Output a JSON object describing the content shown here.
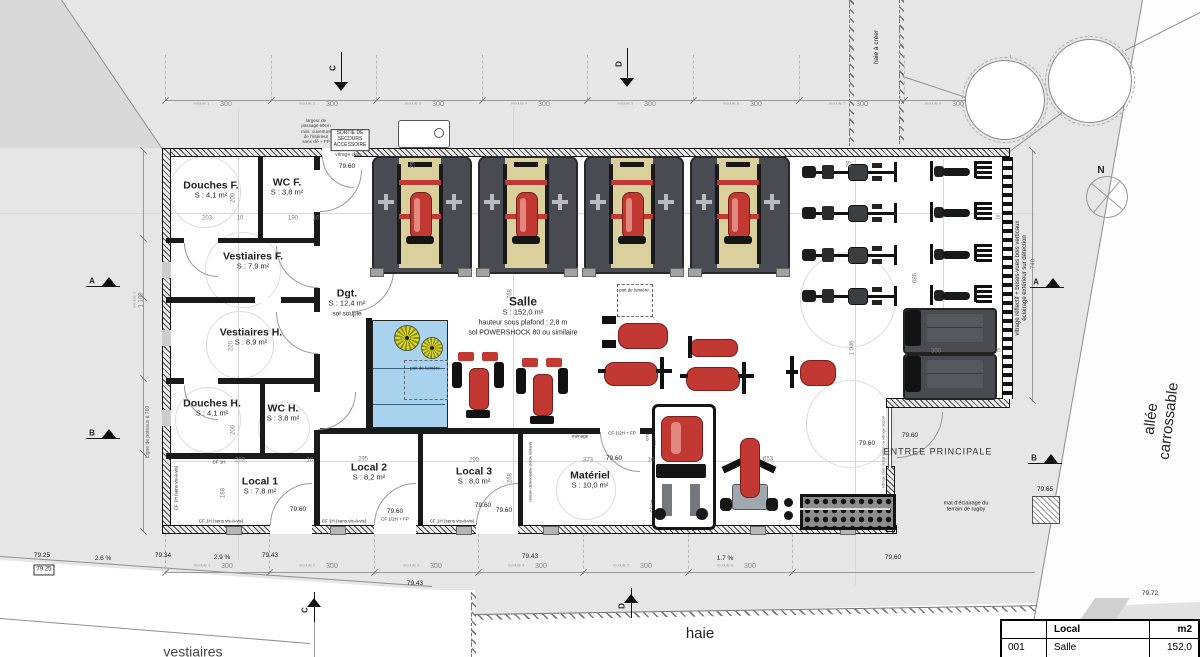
{
  "legend": {
    "col_local": "Local",
    "col_m2": "m2",
    "row_num": "001",
    "row_name": "Salle",
    "row_area": "152,0"
  },
  "rooms": [
    {
      "name": "Douches F.",
      "area": "S : 4,1 m²",
      "x": 211,
      "y": 190
    },
    {
      "name": "WC F.",
      "area": "S : 3,8 m²",
      "x": 287,
      "y": 187
    },
    {
      "name": "Vestiaires F.",
      "area": "S : 7,9 m²",
      "x": 253,
      "y": 261
    },
    {
      "name": "Dgt.",
      "area": "S : 12,4 m²",
      "notes": [
        "sol souple"
      ],
      "x": 347,
      "y": 303
    },
    {
      "name": "Vestiaires H.",
      "area": "S : 8,9 m²",
      "x": 251,
      "y": 337
    },
    {
      "name": "Douches H.",
      "area": "S : 4,1 m²",
      "x": 212,
      "y": 408
    },
    {
      "name": "WC H.",
      "area": "S : 3,8 m²",
      "x": 283,
      "y": 413
    },
    {
      "name": "Local 1",
      "area": "S : 7,8 m²",
      "x": 260,
      "y": 486
    },
    {
      "name": "Local 2",
      "area": "S : 8,2 m²",
      "x": 369,
      "y": 472
    },
    {
      "name": "Local 3",
      "area": "S : 8,0 m²",
      "x": 474,
      "y": 476
    },
    {
      "name": "Matériel",
      "area": "S : 10,0 m²",
      "x": 590,
      "y": 480
    },
    {
      "name": "Salle",
      "area": "S : 152,0 m²",
      "notes": [
        "hauteur sous plafond : 2,8 m",
        "sol POWERSHOCK 80 ou similaire"
      ],
      "x": 523,
      "y": 316,
      "big": 1
    }
  ],
  "labels": [
    {
      "t": "largeur de\npassage 90cm\nmini. ouverture\nde l'intérieur\nsans clé + FP",
      "x": 316,
      "y": 131,
      "s": 4.5,
      "c": "#444"
    },
    {
      "t": "SORTIE DE\nSECOURS\nACCESSOIRE",
      "x": 350,
      "y": 140,
      "s": 5,
      "bx": 1
    },
    {
      "t": "vitrage clair",
      "x": 348,
      "y": 156,
      "s": 5,
      "c": "#555"
    },
    {
      "t": "79.60",
      "x": 347,
      "y": 167
    },
    {
      "t": "puit de lumière",
      "x": 425,
      "y": 368,
      "s": 4.5
    },
    {
      "t": "puit de lumière",
      "x": 634,
      "y": 290,
      "s": 4.5
    },
    {
      "t": "ménage",
      "x": 580,
      "y": 436,
      "s": 4.5
    },
    {
      "t": "CF 1H",
      "x": 219,
      "y": 462,
      "s": 4.5
    },
    {
      "t": "CF 1H",
      "x": 363,
      "y": 432,
      "s": 4.5
    },
    {
      "t": "CF 1H",
      "x": 468,
      "y": 432,
      "s": 4.5
    },
    {
      "t": "CF 1H",
      "x": 559,
      "y": 432,
      "s": 4.5
    },
    {
      "t": "CF 1/2H + FP",
      "x": 622,
      "y": 433,
      "s": 4.5
    },
    {
      "t": "CF 1/2H + FP",
      "x": 395,
      "y": 519,
      "s": 4.5
    },
    {
      "t": "CF 1H (sens vis-à-vis)",
      "x": 221,
      "y": 521,
      "s": 4.5
    },
    {
      "t": "CF 1H (sens vis-à-vis)",
      "x": 344,
      "y": 521,
      "s": 4.5
    },
    {
      "t": "CF 1H (sens vis-à-vis)",
      "x": 452,
      "y": 521,
      "s": 4.5
    },
    {
      "t": "CF 1H (sens vis-à-vis)",
      "x": 176,
      "y": 488,
      "s": 4.5,
      "r": -90
    },
    {
      "t": "CF 1H",
      "x": 652,
      "y": 506,
      "s": 4.5,
      "r": -90
    },
    {
      "t": "cloison démontable (socle isolant)",
      "x": 531,
      "y": 472,
      "s": 4,
      "r": -90
    },
    {
      "t": "GTL",
      "x": 648,
      "y": 437,
      "s": 4,
      "r": -90
    },
    {
      "t": "TGBT",
      "x": 655,
      "y": 443,
      "s": 4,
      "r": -90
    },
    {
      "t": "vitrage clair sérigraphié ou vitrage dépoli",
      "x": 884,
      "y": 452,
      "s": 4,
      "r": -90,
      "c": "#555"
    },
    {
      "t": "vitrage réflectif + brises-vues bois verticaux\néclairage extérieur sur détection",
      "x": 1022,
      "y": 278,
      "s": 6,
      "r": -90
    },
    {
      "t": "ENTREE PRINCIPALE",
      "x": 938,
      "y": 452,
      "s": 9,
      "ls": 1,
      "c": "#333"
    },
    {
      "t": "mat d'éclairage du\nterrain de rugby",
      "x": 966,
      "y": 507,
      "s": 5.5
    },
    {
      "t": "hortensia\nconservé",
      "x": 1005,
      "y": 101,
      "s": 6
    },
    {
      "t": "hortensia\nconservé",
      "x": 1090,
      "y": 80,
      "s": 6
    },
    {
      "t": "haie à créer",
      "x": 877,
      "y": 47,
      "s": 6.5,
      "r": -90
    },
    {
      "t": "haie",
      "x": 700,
      "y": 634,
      "s": 15
    },
    {
      "t": "allée carrossable",
      "x": 1160,
      "y": 420,
      "s": 15,
      "r": -83
    },
    {
      "t": "vestiaires",
      "x": 193,
      "y": 652,
      "s": 14,
      "c": "#444"
    },
    {
      "t": "N",
      "x": 1101,
      "y": 171,
      "s": 10,
      "b": 1
    },
    {
      "t": "203",
      "x": 207,
      "y": 219,
      "dim": 1
    },
    {
      "t": "10",
      "x": 240,
      "y": 219,
      "dim": 1
    },
    {
      "t": "190",
      "x": 293,
      "y": 219,
      "dim": 1
    },
    {
      "t": "10",
      "x": 316,
      "y": 219,
      "dim": 1
    },
    {
      "t": "200",
      "x": 234,
      "y": 198,
      "r": -90,
      "dim": 1
    },
    {
      "t": "220",
      "x": 232,
      "y": 346,
      "r": -90,
      "dim": 1
    },
    {
      "t": "200",
      "x": 234,
      "y": 430,
      "r": -90,
      "dim": 1
    },
    {
      "t": "188",
      "x": 224,
      "y": 493,
      "r": -90,
      "dim": 1
    },
    {
      "t": "203",
      "x": 240,
      "y": 461,
      "dim": 1
    },
    {
      "t": "10",
      "x": 310,
      "y": 461,
      "dim": 1
    },
    {
      "t": "295",
      "x": 363,
      "y": 460,
      "dim": 1
    },
    {
      "t": "290",
      "x": 474,
      "y": 461,
      "dim": 1
    },
    {
      "t": "373",
      "x": 588,
      "y": 461,
      "dim": 1
    },
    {
      "t": "10",
      "x": 651,
      "y": 461,
      "dim": 1
    },
    {
      "t": "653",
      "x": 768,
      "y": 460,
      "dim": 1
    },
    {
      "t": "268",
      "x": 511,
      "y": 478,
      "r": -90,
      "dim": 1
    },
    {
      "t": "768",
      "x": 511,
      "y": 294,
      "r": -90,
      "dim": 1
    },
    {
      "t": "686",
      "x": 916,
      "y": 278,
      "r": -90,
      "dim": 1
    },
    {
      "t": "1 046",
      "x": 853,
      "y": 348,
      "r": -90,
      "dim": 1
    },
    {
      "t": "740",
      "x": 1034,
      "y": 264,
      "r": -90,
      "dim": 1
    },
    {
      "t": "29",
      "x": 414,
      "y": 165,
      "r": -90,
      "dim": 1
    },
    {
      "t": "29",
      "x": 850,
      "y": 164,
      "r": -90,
      "dim": 1
    },
    {
      "t": "35",
      "x": 998,
      "y": 219,
      "s": 5,
      "dim": 1
    },
    {
      "t": "35",
      "x": 998,
      "y": 352,
      "s": 5,
      "dim": 1
    },
    {
      "t": "300",
      "x": 936,
      "y": 352,
      "dim": 1
    },
    {
      "t": "1 100",
      "x": 142,
      "y": 300,
      "r": -90,
      "dim": 1
    },
    {
      "t": "module 1",
      "x": 135,
      "y": 300,
      "r": -90,
      "s": 4,
      "c": "#999"
    },
    {
      "t": "Ligne de poteaux à 760",
      "x": 149,
      "y": 432,
      "s": 5,
      "r": -90,
      "c": "#666"
    },
    {
      "t": "79.60",
      "x": 298,
      "y": 510
    },
    {
      "t": "79.60",
      "x": 395,
      "y": 512
    },
    {
      "t": "79.60",
      "x": 483,
      "y": 506
    },
    {
      "t": "79.60",
      "x": 504,
      "y": 511
    },
    {
      "t": "79.60",
      "x": 614,
      "y": 459
    },
    {
      "t": "79.60",
      "x": 867,
      "y": 444
    },
    {
      "t": "79.60",
      "x": 910,
      "y": 436
    },
    {
      "t": "79,60",
      "x": 893,
      "y": 558
    },
    {
      "t": "79.25",
      "x": 42,
      "y": 556
    },
    {
      "t": "79.25",
      "x": 44,
      "y": 570,
      "bx": 1,
      "s": 6
    },
    {
      "t": "79.34",
      "x": 163,
      "y": 556
    },
    {
      "t": "79.43",
      "x": 270,
      "y": 556
    },
    {
      "t": "79.43",
      "x": 530,
      "y": 557
    },
    {
      "t": "79.43",
      "x": 415,
      "y": 584
    },
    {
      "t": "79.65",
      "x": 1045,
      "y": 490
    },
    {
      "t": "79.72",
      "x": 1150,
      "y": 594
    },
    {
      "t": "2.6 %",
      "x": 103,
      "y": 559
    },
    {
      "t": "2.9 %",
      "x": 222,
      "y": 558
    },
    {
      "t": "1.7 %",
      "x": 725,
      "y": 559
    }
  ],
  "modules_top": {
    "y": 104,
    "value": "300",
    "items": [
      {
        "n": "module 1",
        "x": 216
      },
      {
        "n": "module 2",
        "x": 322
      },
      {
        "n": "module 3",
        "x": 428
      },
      {
        "n": "module 4",
        "x": 534
      },
      {
        "n": "module 5",
        "x": 640
      },
      {
        "n": "module 6",
        "x": 746
      },
      {
        "n": "module 7",
        "x": 852
      },
      {
        "n": "module 8",
        "x": 948
      }
    ]
  },
  "modules_bottom": {
    "y": 566,
    "value": "300",
    "items": [
      {
        "n": "module 1",
        "x": 217
      },
      {
        "n": "module 2",
        "x": 322
      },
      {
        "n": "module 3",
        "x": 426
      },
      {
        "n": "module 4",
        "x": 531
      },
      {
        "n": "module 5",
        "x": 636
      },
      {
        "n": "module 6",
        "x": 740
      }
    ]
  },
  "sections": [
    {
      "l": "A",
      "x": 86,
      "y": 276,
      "o": "h"
    },
    {
      "l": "B",
      "x": 86,
      "y": 428,
      "o": "h"
    },
    {
      "l": "A",
      "x": 1030,
      "y": 277,
      "o": "h"
    },
    {
      "l": "B",
      "x": 1028,
      "y": 453,
      "o": "h"
    },
    {
      "l": "C",
      "x": 341,
      "y": 52,
      "o": "v"
    },
    {
      "l": "D",
      "x": 627,
      "y": 48,
      "o": "v"
    },
    {
      "l": "C",
      "x": 314,
      "y": 592,
      "o": "vb"
    },
    {
      "l": "D",
      "x": 631,
      "y": 588,
      "o": "vb"
    }
  ],
  "colors": {
    "red": "#c23832",
    "red_dark": "#7c1d18",
    "red_light": "#e2897f",
    "platform": "#484c52",
    "platform_border": "#27292c",
    "tan": "#d9d09b",
    "steel": "#17181a",
    "gray_eq": "#b9bcbe",
    "terrace_blue": "#a9d2ef",
    "parasol_yellow": "#d8d829",
    "parasol_dark": "#8f9214",
    "site_gray": "#e6e6e6",
    "wall_black": "#1a1a1a"
  }
}
